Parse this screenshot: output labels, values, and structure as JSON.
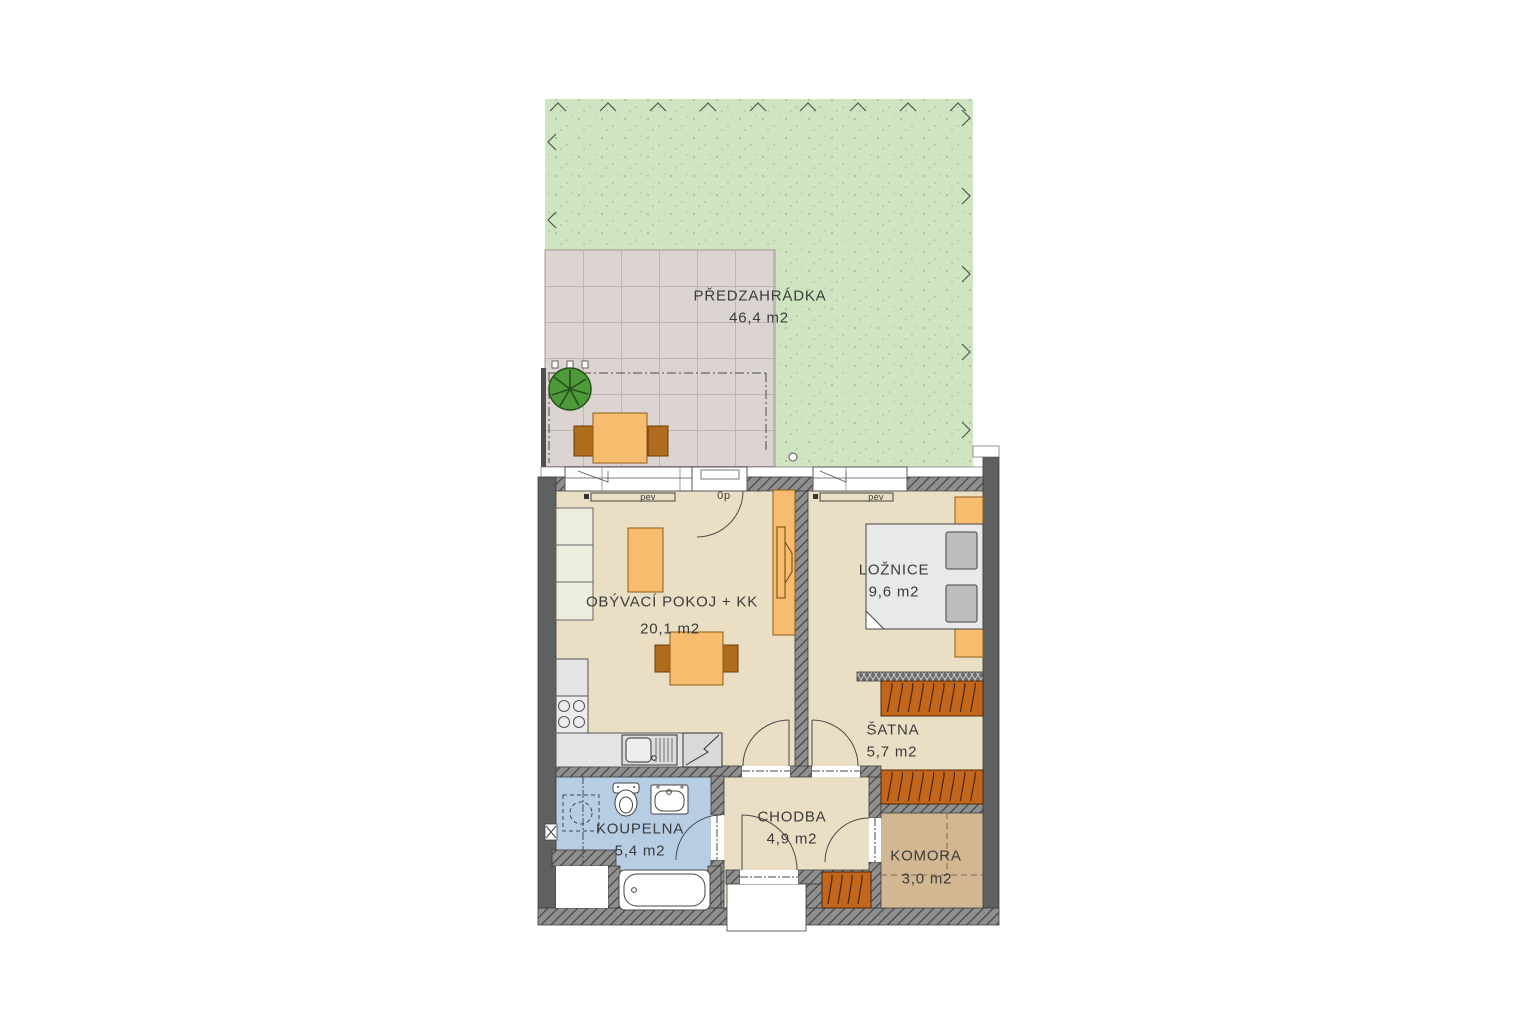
{
  "plan": {
    "rooms": {
      "garden": {
        "label": "PŘEDZAHRÁDKA",
        "area": "46,4 m2"
      },
      "living_room": {
        "label": "OBÝVACÍ POKOJ + KK",
        "area": "20,1 m2"
      },
      "bedroom": {
        "label": "LOŽNICE",
        "area": "9,6 m2"
      },
      "walk_in_closet": {
        "label": "ŠATNA",
        "area": "5,7 m2"
      },
      "hallway": {
        "label": "CHODBA",
        "area": "4,9 m2"
      },
      "bathroom": {
        "label": "KOUPELNA",
        "area": "5,4 m2"
      },
      "storage": {
        "label": "KOMORA",
        "area": "3,0 m2"
      }
    },
    "annotations": {
      "radiator_living": "pev",
      "radiator_bedroom": "pev",
      "garden_door": "0p"
    },
    "colors": {
      "grass": "#cfe5c2",
      "paving": "#dcd4d1",
      "floor": "#eadfc5",
      "bathroom_floor": "#b7cde3",
      "storage_floor": "#d3b793",
      "wall": "#5f6060",
      "furniture_orange": "#f7bc6e",
      "furniture_brown": "#c2661c",
      "bed_grey": "#e9e9e9",
      "text": "#3b3b3b"
    }
  }
}
